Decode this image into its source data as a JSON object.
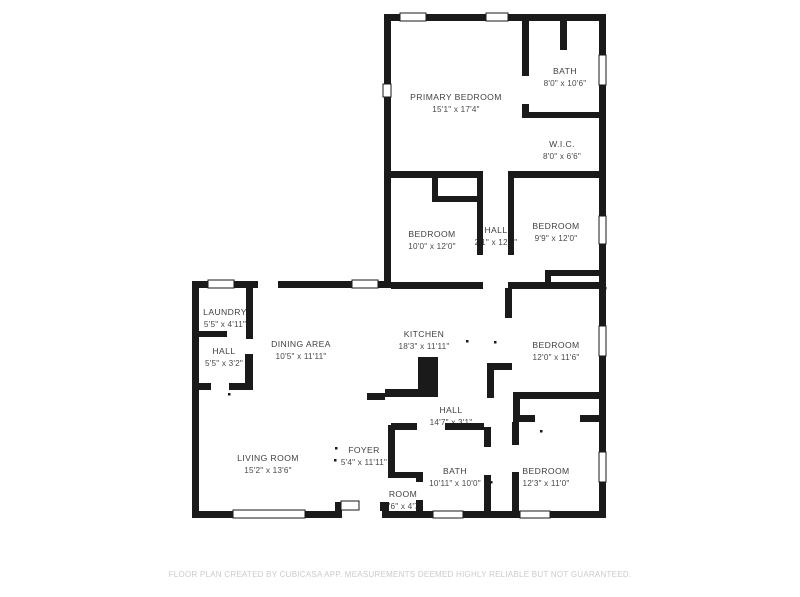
{
  "page": {
    "footer": "FLOOR PLAN CREATED BY CUBICASA APP. MEASUREMENTS DEEMED HIGHLY RELIABLE BUT NOT GUARANTEED."
  },
  "floorplan": {
    "wall_color": "#1a1a1a",
    "label_color": "#3f3f3f",
    "dims_color": "#4a4a4a",
    "footer_color": "#cbcbcb",
    "background_color": "#ffffff",
    "rooms": [
      {
        "name": "PRIMARY BEDROOM",
        "dims": "15'1\" x 17'4\"",
        "x": 456,
        "y": 97
      },
      {
        "name": "BATH",
        "dims": "8'0\" x 10'6\"",
        "x": 565,
        "y": 71
      },
      {
        "name": "W.I.C.",
        "dims": "8'0\" x 6'6\"",
        "x": 562,
        "y": 144
      },
      {
        "name": "BEDROOM",
        "dims": "10'0\" x 12'0\"",
        "x": 432,
        "y": 234
      },
      {
        "name": "HALL",
        "dims": "2'1\" x 12'4\"",
        "x": 496,
        "y": 230
      },
      {
        "name": "BEDROOM",
        "dims": "9'9\" x 12'0\"",
        "x": 556,
        "y": 226
      },
      {
        "name": "LAUNDRY",
        "dims": "5'5\" x 4'11\"",
        "x": 225,
        "y": 312
      },
      {
        "name": "HALL",
        "dims": "5'5\" x 3'2\"",
        "x": 224,
        "y": 351
      },
      {
        "name": "DINING AREA",
        "dims": "10'5\" x 11'11\"",
        "x": 301,
        "y": 344
      },
      {
        "name": "KITCHEN",
        "dims": "18'3\" x 11'11\"",
        "x": 424,
        "y": 334
      },
      {
        "name": "BEDROOM",
        "dims": "12'0\" x 11'6\"",
        "x": 556,
        "y": 345
      },
      {
        "name": "HALL",
        "dims": "14'7\" x 3'1\"",
        "x": 451,
        "y": 410
      },
      {
        "name": "FOYER",
        "dims": "5'4\" x 11'11\"",
        "x": 364,
        "y": 450
      },
      {
        "name": "BATH",
        "dims": "10'11\" x 10'0\"",
        "x": 455,
        "y": 471
      },
      {
        "name": "ROOM",
        "dims": "3'6\" x 4'7\"",
        "x": 403,
        "y": 494
      },
      {
        "name": "BEDROOM",
        "dims": "12'3\" x 11'0\"",
        "x": 546,
        "y": 471
      },
      {
        "name": "LIVING ROOM",
        "dims": "15'2\" x 13'6\"",
        "x": 268,
        "y": 458
      }
    ],
    "walls": [
      [
        384,
        14,
        222,
        7
      ],
      [
        599,
        14,
        7,
        504
      ],
      [
        384,
        14,
        7,
        274
      ],
      [
        192,
        281,
        66,
        7
      ],
      [
        278,
        281,
        113,
        7
      ],
      [
        192,
        281,
        7,
        237
      ],
      [
        192,
        511,
        143,
        7
      ],
      [
        335,
        502,
        7,
        16
      ],
      [
        382,
        502,
        7,
        16
      ],
      [
        389,
        511,
        217,
        7
      ],
      [
        522,
        14,
        7,
        62
      ],
      [
        522,
        104,
        7,
        14
      ],
      [
        560,
        14,
        7,
        36
      ],
      [
        522,
        112,
        84,
        6
      ],
      [
        384,
        171,
        99,
        7
      ],
      [
        508,
        171,
        98,
        7
      ],
      [
        432,
        178,
        6,
        24
      ],
      [
        438,
        196,
        45,
        6
      ],
      [
        477,
        178,
        6,
        77
      ],
      [
        508,
        178,
        6,
        77
      ],
      [
        545,
        270,
        6,
        19
      ],
      [
        545,
        270,
        54,
        6
      ],
      [
        391,
        282,
        92,
        7
      ],
      [
        508,
        282,
        98,
        7
      ],
      [
        246,
        281,
        7,
        58
      ],
      [
        199,
        331,
        28,
        6
      ],
      [
        245,
        354,
        8,
        36
      ],
      [
        199,
        383,
        12,
        7
      ],
      [
        229,
        383,
        17,
        7
      ],
      [
        367,
        393,
        18,
        7
      ],
      [
        487,
        363,
        7,
        35
      ],
      [
        487,
        363,
        25,
        7
      ],
      [
        505,
        288,
        7,
        30
      ],
      [
        513,
        392,
        93,
        7
      ],
      [
        513,
        399,
        7,
        16
      ],
      [
        513,
        415,
        22,
        7
      ],
      [
        580,
        415,
        26,
        7
      ],
      [
        512,
        422,
        7,
        23
      ],
      [
        512,
        472,
        7,
        39
      ],
      [
        484,
        427,
        7,
        20
      ],
      [
        484,
        475,
        7,
        36
      ],
      [
        391,
        423,
        26,
        7
      ],
      [
        445,
        423,
        39,
        7
      ],
      [
        388,
        425,
        7,
        53
      ],
      [
        388,
        472,
        34,
        6
      ],
      [
        416,
        472,
        7,
        10
      ],
      [
        416,
        500,
        7,
        11
      ],
      [
        380,
        502,
        8,
        9
      ]
    ],
    "windows": [
      [
        400,
        13,
        26,
        8
      ],
      [
        486,
        13,
        22,
        8
      ],
      [
        599,
        55,
        7,
        30
      ],
      [
        599,
        216,
        7,
        28
      ],
      [
        599,
        326,
        7,
        30
      ],
      [
        599,
        452,
        7,
        30
      ],
      [
        383,
        84,
        8,
        13
      ],
      [
        208,
        280,
        26,
        8
      ],
      [
        352,
        280,
        26,
        8
      ],
      [
        233,
        510,
        72,
        8
      ],
      [
        433,
        511,
        30,
        7
      ],
      [
        520,
        511,
        30,
        7
      ]
    ],
    "features": {
      "kitchen_island": [
        [
          418,
          357,
          20,
          40
        ],
        [
          385,
          389,
          33,
          8
        ]
      ],
      "entry_stoop": [
        341,
        501,
        18,
        9
      ]
    },
    "door_marks": [
      [
        335,
        447
      ],
      [
        334,
        459
      ],
      [
        466,
        340
      ],
      [
        494,
        341
      ],
      [
        540,
        430
      ],
      [
        490,
        481
      ],
      [
        228,
        393
      ],
      [
        604,
        287
      ]
    ]
  }
}
